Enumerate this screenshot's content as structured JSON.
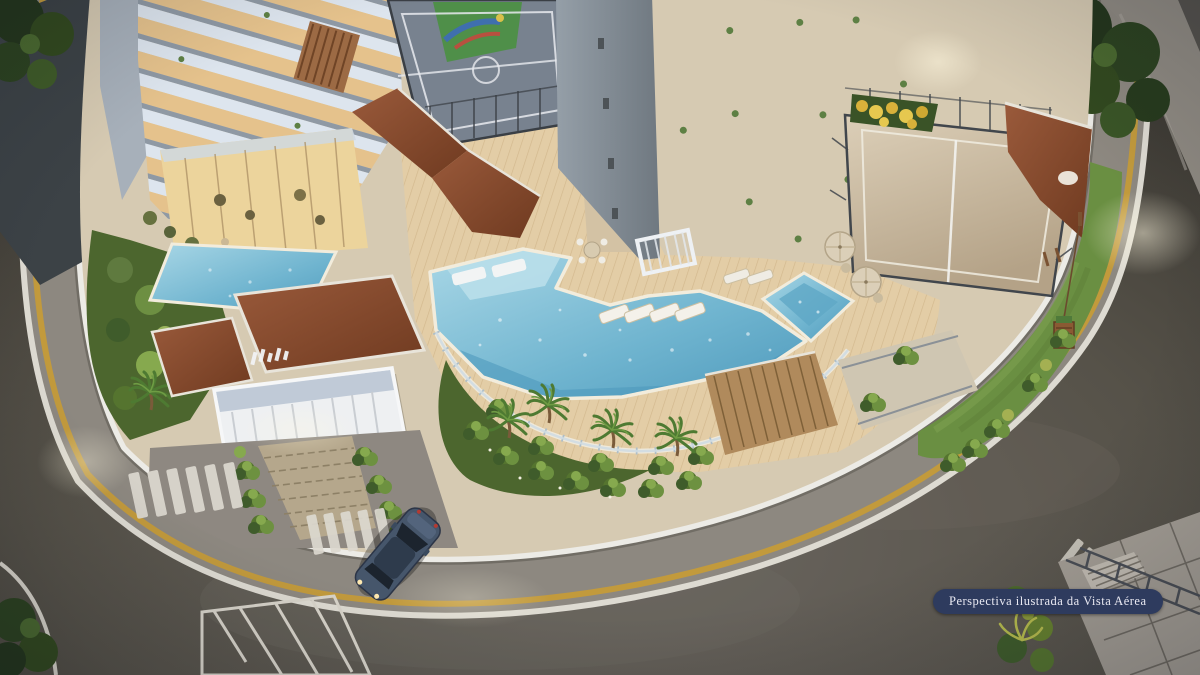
{
  "meta": {
    "title": "Aerial dusk rendering of residential condominium leisure podium",
    "render_type": "architectural illustration"
  },
  "caption": {
    "label": "Perspectiva ilustrada da Vista Aérea"
  },
  "palette": {
    "badge_bg": "#2e3b5e",
    "badge_text": "#e9e9f2",
    "pool_water": "#6fb4cf",
    "pool_shallow": "#b7dde9",
    "deck_wood": "#e3cda6",
    "sand_court": "#cfc1a7",
    "sport_court": "#78828f",
    "roof_terracotta": "#8a4b2c",
    "asphalt": "#4e4a45",
    "sidewalk": "#8d8880",
    "curb_yellow": "#c29a3c",
    "lawn_green": "#6a8f42",
    "foliage_dark": "#32491f",
    "tower_white": "#e3eaf1",
    "window_warm": "#e0b887",
    "wall_white": "#ecebe6"
  },
  "scene": {
    "areas": [
      {
        "id": "left-tower",
        "label": "Residential tower with lit balconies (left)"
      },
      {
        "id": "central-tower",
        "label": "Residential tower with lit balconies (center)"
      },
      {
        "id": "multisport-court",
        "label": "Fenced multisport court"
      },
      {
        "id": "playground-soft-area",
        "label": "Colorful playground surface behind court"
      },
      {
        "id": "beach-tennis-court",
        "label": "Sand beach-tennis / volleyball court"
      },
      {
        "id": "main-pool",
        "label": "Main leisure pool with in-water loungers"
      },
      {
        "id": "kids-pool",
        "label": "Small square pool with umbrellas"
      },
      {
        "id": "lap-pool",
        "label": "Reflecting lap pool by left tower"
      },
      {
        "id": "pool-deck",
        "label": "Wooden pool deck with sun loungers and pergola"
      },
      {
        "id": "entrance-pavilion",
        "label": "Entrance pavilion with terracotta roofs"
      },
      {
        "id": "entrance-canopy",
        "label": "White louvered entrance canopy with glass facade"
      },
      {
        "id": "driveway",
        "label": "Paver driveway with hedges and crosswalks"
      },
      {
        "id": "suv-car",
        "label": "Dark blue SUV entering the driveway"
      },
      {
        "id": "playground-lawn",
        "label": "Curved lawn strip with wooden play structure"
      },
      {
        "id": "perimeter-road",
        "label": "Curved asphalt street with markings"
      },
      {
        "id": "corner-stairs",
        "label": "Sidewalk stairs and railing at lower-right corner"
      },
      {
        "id": "street-trees",
        "label": "Dense street trees at corners"
      },
      {
        "id": "caption-badge",
        "label": "Caption pill badge"
      }
    ]
  }
}
